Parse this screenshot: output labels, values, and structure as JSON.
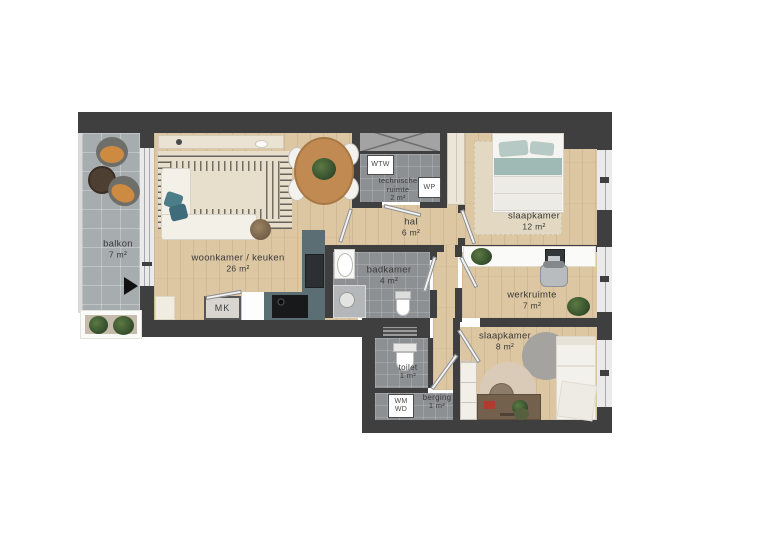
{
  "rooms": {
    "balkon": {
      "name": "balkon",
      "area": "7 m²"
    },
    "woonkamer": {
      "name": "woonkamer / keuken",
      "area": "26 m²"
    },
    "technische_ruimte": {
      "name_line1": "technische",
      "name_line2": "ruimte",
      "area": "2 m²"
    },
    "hal": {
      "name": "hal",
      "area": "6 m²"
    },
    "slaapkamer1": {
      "name": "slaapkamer",
      "area": "12 m²"
    },
    "badkamer": {
      "name": "badkamer",
      "area": "4 m²"
    },
    "werkruimte": {
      "name": "werkruimte",
      "area": "7 m²"
    },
    "slaapkamer2": {
      "name": "slaapkamer",
      "area": "8 m²"
    },
    "toilet": {
      "name": "toilet",
      "area": "1 m²"
    },
    "berging": {
      "name": "berging",
      "area": "1 m²"
    }
  },
  "equipment": {
    "mk": "MK",
    "wtw": "WTW",
    "wp": "WP",
    "wm": "WM",
    "wd": "WD"
  },
  "colors": {
    "wall": "#3f3f3f",
    "wood": "#dcc7a2",
    "tile": "#8d9092",
    "balcony_tile": "#a7acaf",
    "counter": "#5a6e73",
    "accent_teal": "#9fb9b4"
  }
}
